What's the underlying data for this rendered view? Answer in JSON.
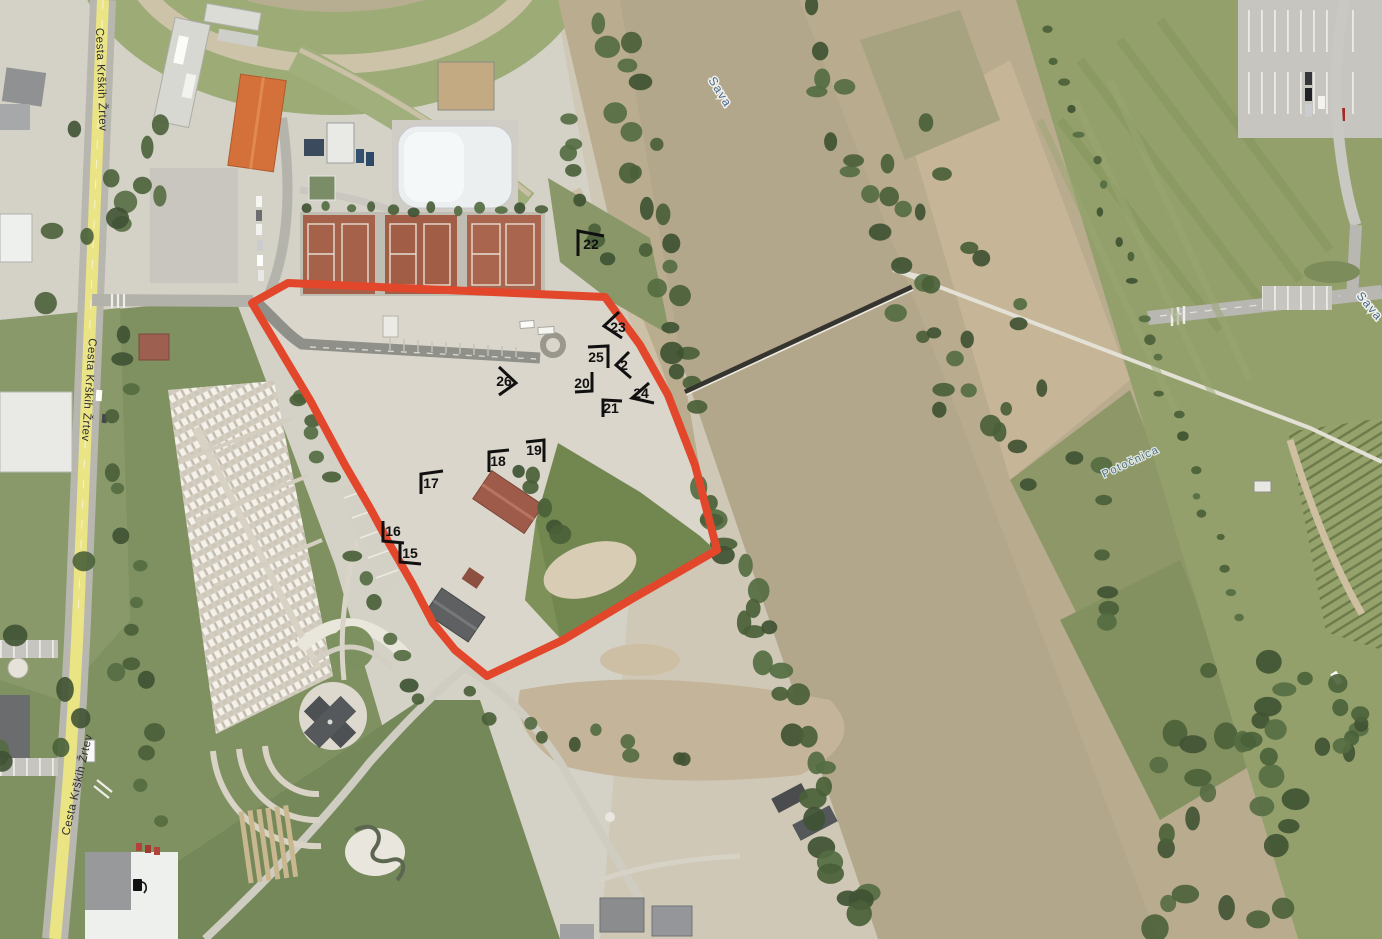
{
  "map": {
    "description": "aerial-orthophoto-with-site-boundary",
    "boundary": {
      "name": "site-boundary",
      "color": "#e2472b",
      "stroke_width": 8,
      "points": [
        [
          288,
          283
        ],
        [
          605,
          297
        ],
        [
          640,
          345
        ],
        [
          668,
          395
        ],
        [
          695,
          465
        ],
        [
          717,
          550
        ],
        [
          630,
          600
        ],
        [
          563,
          640
        ],
        [
          487,
          676
        ],
        [
          455,
          650
        ],
        [
          433,
          623
        ],
        [
          412,
          583
        ],
        [
          390,
          545
        ],
        [
          370,
          508
        ],
        [
          345,
          465
        ],
        [
          310,
          400
        ],
        [
          252,
          303
        ]
      ]
    },
    "photo_markers": [
      {
        "n": "22",
        "a": [
          578,
          256
        ],
        "t": [
          578,
          231
        ],
        "b": [
          604,
          236
        ],
        "lx": 591,
        "ly": 244
      },
      {
        "n": "23",
        "a": [
          619,
          312
        ],
        "t": [
          604,
          326
        ],
        "b": [
          622,
          338
        ],
        "lx": 618,
        "ly": 327
      },
      {
        "n": "25",
        "a": [
          588,
          347
        ],
        "t": [
          608,
          346
        ],
        "b": [
          608,
          368
        ],
        "lx": 596,
        "ly": 357
      },
      {
        "n": "2",
        "a": [
          629,
          352
        ],
        "t": [
          616,
          365
        ],
        "b": [
          631,
          378
        ],
        "lx": 624,
        "ly": 365
      },
      {
        "n": "26",
        "a": [
          499,
          367
        ],
        "t": [
          516,
          383
        ],
        "b": [
          499,
          395
        ],
        "lx": 504,
        "ly": 381
      },
      {
        "n": "20",
        "a": [
          575,
          392
        ],
        "t": [
          592,
          391
        ],
        "b": [
          592,
          372
        ],
        "lx": 582,
        "ly": 383
      },
      {
        "n": "24",
        "a": [
          649,
          383
        ],
        "t": [
          632,
          398
        ],
        "b": [
          654,
          403
        ],
        "lx": 641,
        "ly": 393
      },
      {
        "n": "21",
        "a": [
          603,
          417
        ],
        "t": [
          603,
          400
        ],
        "b": [
          622,
          401
        ],
        "lx": 611,
        "ly": 408
      },
      {
        "n": "19",
        "a": [
          526,
          442
        ],
        "t": [
          544,
          440
        ],
        "b": [
          544,
          462
        ],
        "lx": 534,
        "ly": 450
      },
      {
        "n": "18",
        "a": [
          509,
          450
        ],
        "t": [
          489,
          452
        ],
        "b": [
          489,
          472
        ],
        "lx": 498,
        "ly": 461
      },
      {
        "n": "17",
        "a": [
          443,
          471
        ],
        "t": [
          421,
          474
        ],
        "b": [
          421,
          494
        ],
        "lx": 431,
        "ly": 483
      },
      {
        "n": "16",
        "a": [
          383,
          521
        ],
        "t": [
          383,
          541
        ],
        "b": [
          404,
          543
        ],
        "lx": 393,
        "ly": 531
      },
      {
        "n": "15",
        "a": [
          400,
          543
        ],
        "t": [
          400,
          562
        ],
        "b": [
          421,
          564
        ],
        "lx": 410,
        "ly": 553
      }
    ],
    "road_labels": [
      {
        "id": "cesta-top",
        "text": "Cesta Krških Žrtev",
        "x": 96,
        "y": 28,
        "rotation": 88
      },
      {
        "id": "cesta-mid",
        "text": "Cesta Krških Žrtev",
        "x": 89,
        "y": 338,
        "rotation": 94
      },
      {
        "id": "cesta-bottom",
        "text": "Cesta Krških Žrtev",
        "x": 69,
        "y": 836,
        "rotation": -77
      }
    ],
    "water_labels": [
      {
        "id": "sava-top",
        "text": "Sava",
        "x": 708,
        "y": 80,
        "rotation": 58
      },
      {
        "id": "sava-right",
        "text": "Sava",
        "x": 1356,
        "y": 296,
        "rotation": 50
      }
    ],
    "stream_labels": [
      {
        "id": "potocnica",
        "text": "Potočnica",
        "x": 1104,
        "y": 478,
        "rotation": -25
      }
    ],
    "bridge": {
      "x1": 685,
      "y1": 392,
      "x2": 912,
      "y2": 287
    },
    "fuel_station": {
      "x": 133,
      "y": 879
    },
    "colors": {
      "water": "#b2a68b",
      "boundary": "#e2472b",
      "road_yellow": "#eae388",
      "marker": "#101010",
      "water_label": "#46688e"
    }
  }
}
